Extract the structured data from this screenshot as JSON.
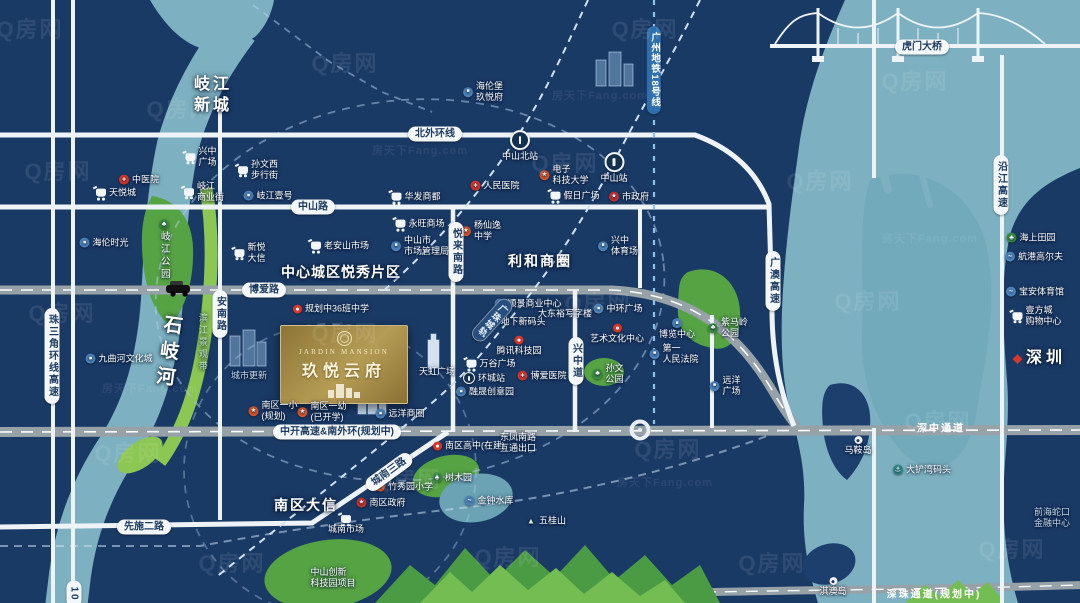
{
  "property": {
    "name_en": "JARDIN MANSION",
    "name_cn": "玖悦云府"
  },
  "map": {
    "colors": {
      "background": "#1a3a66",
      "sea": "#7db1c1",
      "park_green": "#56a344",
      "road_gray": "#97a1a8",
      "brand_gold": "#b59c55",
      "alert_red": "#d4372c"
    },
    "watermark": {
      "text": "Q房网",
      "positions": [
        [
          30,
          28
        ],
        [
          345,
          62
        ],
        [
          645,
          28
        ],
        [
          915,
          80
        ],
        [
          58,
          170
        ],
        [
          565,
          162
        ],
        [
          820,
          180
        ],
        [
          62,
          312
        ],
        [
          345,
          332
        ],
        [
          598,
          302
        ],
        [
          868,
          300
        ],
        [
          128,
          452
        ],
        [
          408,
          478
        ],
        [
          668,
          448
        ],
        [
          938,
          420
        ],
        [
          232,
          562
        ],
        [
          508,
          556
        ],
        [
          772,
          562
        ],
        [
          1012,
          548
        ],
        [
          180,
          108
        ]
      ]
    },
    "watermark2": {
      "text": "房天下Fang.com",
      "positions": [
        [
          600,
          95
        ],
        [
          150,
          388
        ],
        [
          665,
          482
        ],
        [
          930,
          238
        ],
        [
          420,
          150
        ]
      ]
    },
    "area_labels": [
      {
        "id": "qijiang-newtown",
        "lines": [
          "岐江",
          "新城"
        ],
        "x": 213,
        "y": 96,
        "size": 16,
        "ls": 3
      },
      {
        "id": "center-city-yuexiu",
        "lines": [
          "中心城区悦秀片区"
        ],
        "x": 341,
        "y": 272,
        "size": 14,
        "ls": 1
      },
      {
        "id": "lihe-business-circle",
        "lines": [
          "利和商圈"
        ],
        "x": 540,
        "y": 261,
        "size": 14,
        "ls": 2
      },
      {
        "id": "nanqu-daxin",
        "lines": [
          "南区大信"
        ],
        "x": 306,
        "y": 505,
        "size": 14,
        "ls": 2
      },
      {
        "id": "shiqi-river",
        "lines": [
          "石岐河"
        ],
        "x": 166,
        "y": 357,
        "size": 19,
        "ls": 7,
        "vertical": true,
        "rot": 8
      },
      {
        "id": "binjiang-landscape-belt",
        "lines": [
          "滨江景观带"
        ],
        "x": 202,
        "y": 345,
        "size": 9,
        "ls": 3,
        "vertical": true,
        "color": "#bfe3c6",
        "light": true
      },
      {
        "id": "shenzhen",
        "lines": [
          "深圳"
        ],
        "x": 1040,
        "y": 359,
        "size": 16,
        "ls": 4,
        "marker": "diamond"
      }
    ],
    "road_labels": [
      {
        "id": "beiwai-ring-rd",
        "text": "北外环线",
        "x": 435,
        "y": 134,
        "style": "h"
      },
      {
        "id": "zhongshan-rd",
        "text": "中山路",
        "x": 313,
        "y": 207,
        "style": "h"
      },
      {
        "id": "boai-rd",
        "text": "博爱路",
        "x": 264,
        "y": 290,
        "style": "h"
      },
      {
        "id": "annan-rd",
        "text": "安南路",
        "x": 220,
        "y": 314,
        "style": "v"
      },
      {
        "id": "yuelai-south-rd",
        "text": "悦来南路",
        "x": 456,
        "y": 252,
        "style": "v"
      },
      {
        "id": "xingzhong-ave",
        "text": "兴中道",
        "x": 576,
        "y": 361,
        "style": "v"
      },
      {
        "id": "zhusanjiao-ring-expwy",
        "text": "珠三角环线高速",
        "x": 52,
        "y": 356,
        "style": "v"
      },
      {
        "id": "g105-rd",
        "text": "10",
        "x": 74,
        "y": 594,
        "style": "v"
      },
      {
        "id": "xianshi-2nd-rd",
        "text": "先施二路",
        "x": 144,
        "y": 527,
        "style": "h"
      },
      {
        "id": "chengnan-3rd-rd",
        "text": "城南三路",
        "x": 389,
        "y": 472,
        "style": "h",
        "rot": -36
      },
      {
        "id": "zhongkai-expwy-south-ring",
        "text": "中开高速&南外环(规划中)",
        "x": 337,
        "y": 432,
        "style": "h"
      },
      {
        "id": "guangao-expwy",
        "text": "广澳高速",
        "x": 773,
        "y": 281,
        "style": "v"
      },
      {
        "id": "yanjiang-expwy",
        "text": "沿江高速",
        "x": 1001,
        "y": 185,
        "style": "v"
      },
      {
        "id": "humen-bridge",
        "text": "虎门大桥",
        "x": 922,
        "y": 47,
        "style": "h"
      },
      {
        "id": "gz-metro-line18",
        "text": "广州地铁18号线",
        "x": 654,
        "y": 70,
        "style": "vblue"
      },
      {
        "id": "guangzhu-intercity-rail",
        "text": "广珠城轨",
        "x": 492,
        "y": 320,
        "style": "vdark",
        "rot": 42
      },
      {
        "id": "shenzhong-corridor",
        "text": "深中通道",
        "x": 941,
        "y": 429,
        "style": "onroad"
      },
      {
        "id": "shenzhu-corridor",
        "text": "深珠通道(规划中)",
        "x": 934,
        "y": 595,
        "style": "onroad"
      }
    ],
    "pois": [
      {
        "id": "xingzhong-plaza",
        "icon": "cart",
        "lines": [
          "兴中",
          "广场"
        ],
        "x": 201,
        "y": 157
      },
      {
        "id": "sunwenxi-walking-street",
        "icon": "cart",
        "lines": [
          "孙文西",
          "步行街"
        ],
        "x": 258,
        "y": 170
      },
      {
        "id": "qijiang-biz-street",
        "icon": "cart",
        "lines": [
          "岐江",
          "商业街"
        ],
        "x": 204,
        "y": 192
      },
      {
        "id": "qijiang-no1",
        "icon": "biz",
        "lines": [
          "岐江壹号"
        ],
        "x": 268,
        "y": 196
      },
      {
        "id": "tcm-hospital",
        "icon": "med",
        "lines": [
          "中医院"
        ],
        "x": 139,
        "y": 180
      },
      {
        "id": "tianyue-city",
        "icon": "cart",
        "lines": [
          "天悦城"
        ],
        "x": 116,
        "y": 193
      },
      {
        "id": "helen-time",
        "icon": "biz",
        "lines": [
          "海伦时光"
        ],
        "x": 104,
        "y": 243
      },
      {
        "id": "qijiang-park",
        "icon": "park",
        "lines": [
          "岐江公园"
        ],
        "x": 164,
        "y": 250,
        "layout": "vstack"
      },
      {
        "id": "jiuquhe-culture-city",
        "icon": "biz",
        "lines": [
          "九曲河文化城"
        ],
        "x": 119,
        "y": 359
      },
      {
        "id": "huafa-shangdu",
        "icon": "cart",
        "lines": [
          "华发商都"
        ],
        "x": 416,
        "y": 197
      },
      {
        "id": "renmin-hospital",
        "icon": "med",
        "lines": [
          "人民医院"
        ],
        "x": 495,
        "y": 186
      },
      {
        "id": "uestc-zhongshan",
        "icon": "school",
        "lines": [
          "电子",
          "科技大学"
        ],
        "x": 564,
        "y": 175
      },
      {
        "id": "holiday-plaza",
        "icon": "cart",
        "lines": [
          "假日广场"
        ],
        "x": 575,
        "y": 196
      },
      {
        "id": "city-government",
        "icon": "gov",
        "lines": [
          "市政府"
        ],
        "x": 629,
        "y": 197
      },
      {
        "id": "helenbergh-jiuyuefu",
        "icon": "biz",
        "lines": [
          "海伦堡",
          "玖悦府"
        ],
        "x": 483,
        "y": 92
      },
      {
        "id": "zhongshan-north-station",
        "icon": "rail",
        "lines": [
          "中山北站"
        ],
        "x": 520,
        "y": 146,
        "layout": "stack"
      },
      {
        "id": "zhongshan-station",
        "icon": "rail",
        "lines": [
          "中山站"
        ],
        "x": 614,
        "y": 168,
        "layout": "stack"
      },
      {
        "id": "aeon-mall",
        "icon": "cart",
        "lines": [
          "永旺商场"
        ],
        "x": 420,
        "y": 224
      },
      {
        "id": "market-admin-bureau",
        "icon": "biz",
        "lines": [
          "中山市",
          "市场管理局"
        ],
        "x": 420,
        "y": 246
      },
      {
        "id": "yangxianyi-middle-school",
        "icon": "school",
        "lines": [
          "杨仙逸",
          "中学"
        ],
        "x": 481,
        "y": 231
      },
      {
        "id": "xingzhong-stadium",
        "icon": "biz",
        "lines": [
          "兴中",
          "体育场"
        ],
        "x": 618,
        "y": 246
      },
      {
        "id": "laoanshan-market",
        "icon": "cart",
        "lines": [
          "老安山市场"
        ],
        "x": 340,
        "y": 246
      },
      {
        "id": "xinyue-daxin",
        "icon": "cart",
        "lines": [
          "新悦",
          "大信"
        ],
        "x": 250,
        "y": 253
      },
      {
        "id": "planned-36-class-school",
        "icon": "pin",
        "lines": [
          "规划中36班中学"
        ],
        "x": 331,
        "y": 309
      },
      {
        "id": "tianhong-plaza",
        "lines": [
          "天虹广场"
        ],
        "x": 437,
        "y": 372
      },
      {
        "id": "nanqu-first-primary",
        "icon": "school",
        "lines": [
          "南区一小",
          "(规划)"
        ],
        "x": 273,
        "y": 411
      },
      {
        "id": "nanqu-first-kindergarten",
        "icon": "school",
        "lines": [
          "南区一幼",
          "(已开学)"
        ],
        "x": 322,
        "y": 412
      },
      {
        "id": "yuanyang-biz-circle",
        "icon": "biz",
        "lines": [
          "远洋商圈"
        ],
        "x": 400,
        "y": 414
      },
      {
        "id": "wangu-plaza",
        "icon": "cart",
        "lines": [
          "万谷广场"
        ],
        "x": 491,
        "y": 364
      },
      {
        "id": "huancheng-station",
        "icon": "rail",
        "lines": [
          "环城站"
        ],
        "x": 484,
        "y": 378,
        "cls": "sm"
      },
      {
        "id": "boai-hospital",
        "icon": "med",
        "lines": [
          "博爱医院"
        ],
        "x": 542,
        "y": 376
      },
      {
        "id": "rongsheng-creative-park",
        "icon": "biz",
        "lines": [
          "融晟创意园"
        ],
        "x": 485,
        "y": 392
      },
      {
        "id": "tencent-tech-park",
        "icon": "pin",
        "lines": [
          "腾讯科技园"
        ],
        "x": 519,
        "y": 346,
        "layout": "stack"
      },
      {
        "id": "dixia-new-wharf",
        "lines": [
          "地下新码头"
        ],
        "x": 523,
        "y": 322
      },
      {
        "id": "dadongyu-office",
        "lines": [
          "大东裕写字楼"
        ],
        "x": 565,
        "y": 314
      },
      {
        "id": "shunjing-biz-center",
        "icon": "biz",
        "lines": [
          "顺景商业中心"
        ],
        "x": 528,
        "y": 304
      },
      {
        "id": "zhonghuan-plaza",
        "icon": "biz",
        "lines": [
          "中环广场"
        ],
        "x": 618,
        "y": 309
      },
      {
        "id": "art-culture-center",
        "icon": "pin",
        "lines": [
          "艺术文化中心"
        ],
        "x": 617,
        "y": 334,
        "layout": "stack"
      },
      {
        "id": "sunwen-park",
        "icon": "park",
        "lines": [
          "孙文",
          "公园"
        ],
        "x": 608,
        "y": 374
      },
      {
        "id": "expo-center",
        "icon": "biz",
        "lines": [
          "博览中心"
        ],
        "x": 677,
        "y": 329,
        "layout": "stack"
      },
      {
        "id": "first-peoples-court",
        "icon": "biz",
        "lines": [
          "第一",
          "人民法院"
        ],
        "x": 674,
        "y": 354
      },
      {
        "id": "zimaling-park",
        "icon": "park",
        "lines": [
          "紫马岭",
          "公园"
        ],
        "x": 728,
        "y": 328
      },
      {
        "id": "yuanyang-plaza",
        "icon": "biz",
        "lines": [
          "远洋",
          "广场"
        ],
        "x": 725,
        "y": 386
      },
      {
        "id": "maan-island",
        "icon": "island",
        "lines": [
          "马鞍岛"
        ],
        "x": 858,
        "y": 446,
        "layout": "stack"
      },
      {
        "id": "dachanwan-wharf",
        "icon": "anchor",
        "lines": [
          "大铲湾码头"
        ],
        "x": 922,
        "y": 470
      },
      {
        "id": "qianhai-finance-center",
        "lines": [
          "前海蛇口",
          "金融中心"
        ],
        "x": 1052,
        "y": 518,
        "cls": "dim"
      },
      {
        "id": "qiao-island",
        "icon": "island",
        "lines": [
          "淇澳岛"
        ],
        "x": 833,
        "y": 587,
        "layout": "stack"
      },
      {
        "id": "haishang-tianyuan",
        "icon": "park",
        "lines": [
          "海上田园"
        ],
        "x": 1031,
        "y": 238
      },
      {
        "id": "hangang-golf",
        "icon": "water",
        "lines": [
          "航港高尔夫"
        ],
        "x": 1034,
        "y": 257
      },
      {
        "id": "baoan-stadium",
        "icon": "water",
        "lines": [
          "宝安体育馆"
        ],
        "x": 1035,
        "y": 292
      },
      {
        "id": "yifangcheng-mall",
        "icon": "cart",
        "lines": [
          "壹方城",
          "购物中心"
        ],
        "x": 1037,
        "y": 316
      },
      {
        "id": "shumuyuan-arboretum",
        "icon": "park",
        "lines": [
          "树木园"
        ],
        "x": 452,
        "y": 478
      },
      {
        "id": "jinzhong-reservoir",
        "icon": "water",
        "lines": [
          "金钟水库"
        ],
        "x": 489,
        "y": 501
      },
      {
        "id": "wugui-mountain",
        "icon": "mtn",
        "lines": [
          "五桂山"
        ],
        "x": 546,
        "y": 521
      },
      {
        "id": "zhuxiuyuan-primary",
        "icon": "school",
        "lines": [
          "竹秀园小学"
        ],
        "x": 404,
        "y": 487
      },
      {
        "id": "nanqu-government",
        "icon": "gov",
        "lines": [
          "南区政府"
        ],
        "x": 381,
        "y": 503
      },
      {
        "id": "chengnan-market",
        "icon": "cart",
        "lines": [
          "城南市场"
        ],
        "x": 346,
        "y": 525,
        "layout": "stack"
      },
      {
        "id": "nanqu-high-school",
        "icon": "pin",
        "lines": [
          "南区高中(在建)"
        ],
        "x": 469,
        "y": 446
      },
      {
        "id": "innovation-tech-park",
        "lines": [
          "中山创新",
          "科技园项目"
        ],
        "x": 333,
        "y": 578
      },
      {
        "id": "dongfeng-exit",
        "lines": [
          "东凤南路",
          "互通出口"
        ],
        "x": 518,
        "y": 443
      },
      {
        "id": "urban-renewal",
        "lines": [
          "城市更新"
        ],
        "x": 249,
        "y": 376,
        "cls": "dim"
      }
    ]
  }
}
